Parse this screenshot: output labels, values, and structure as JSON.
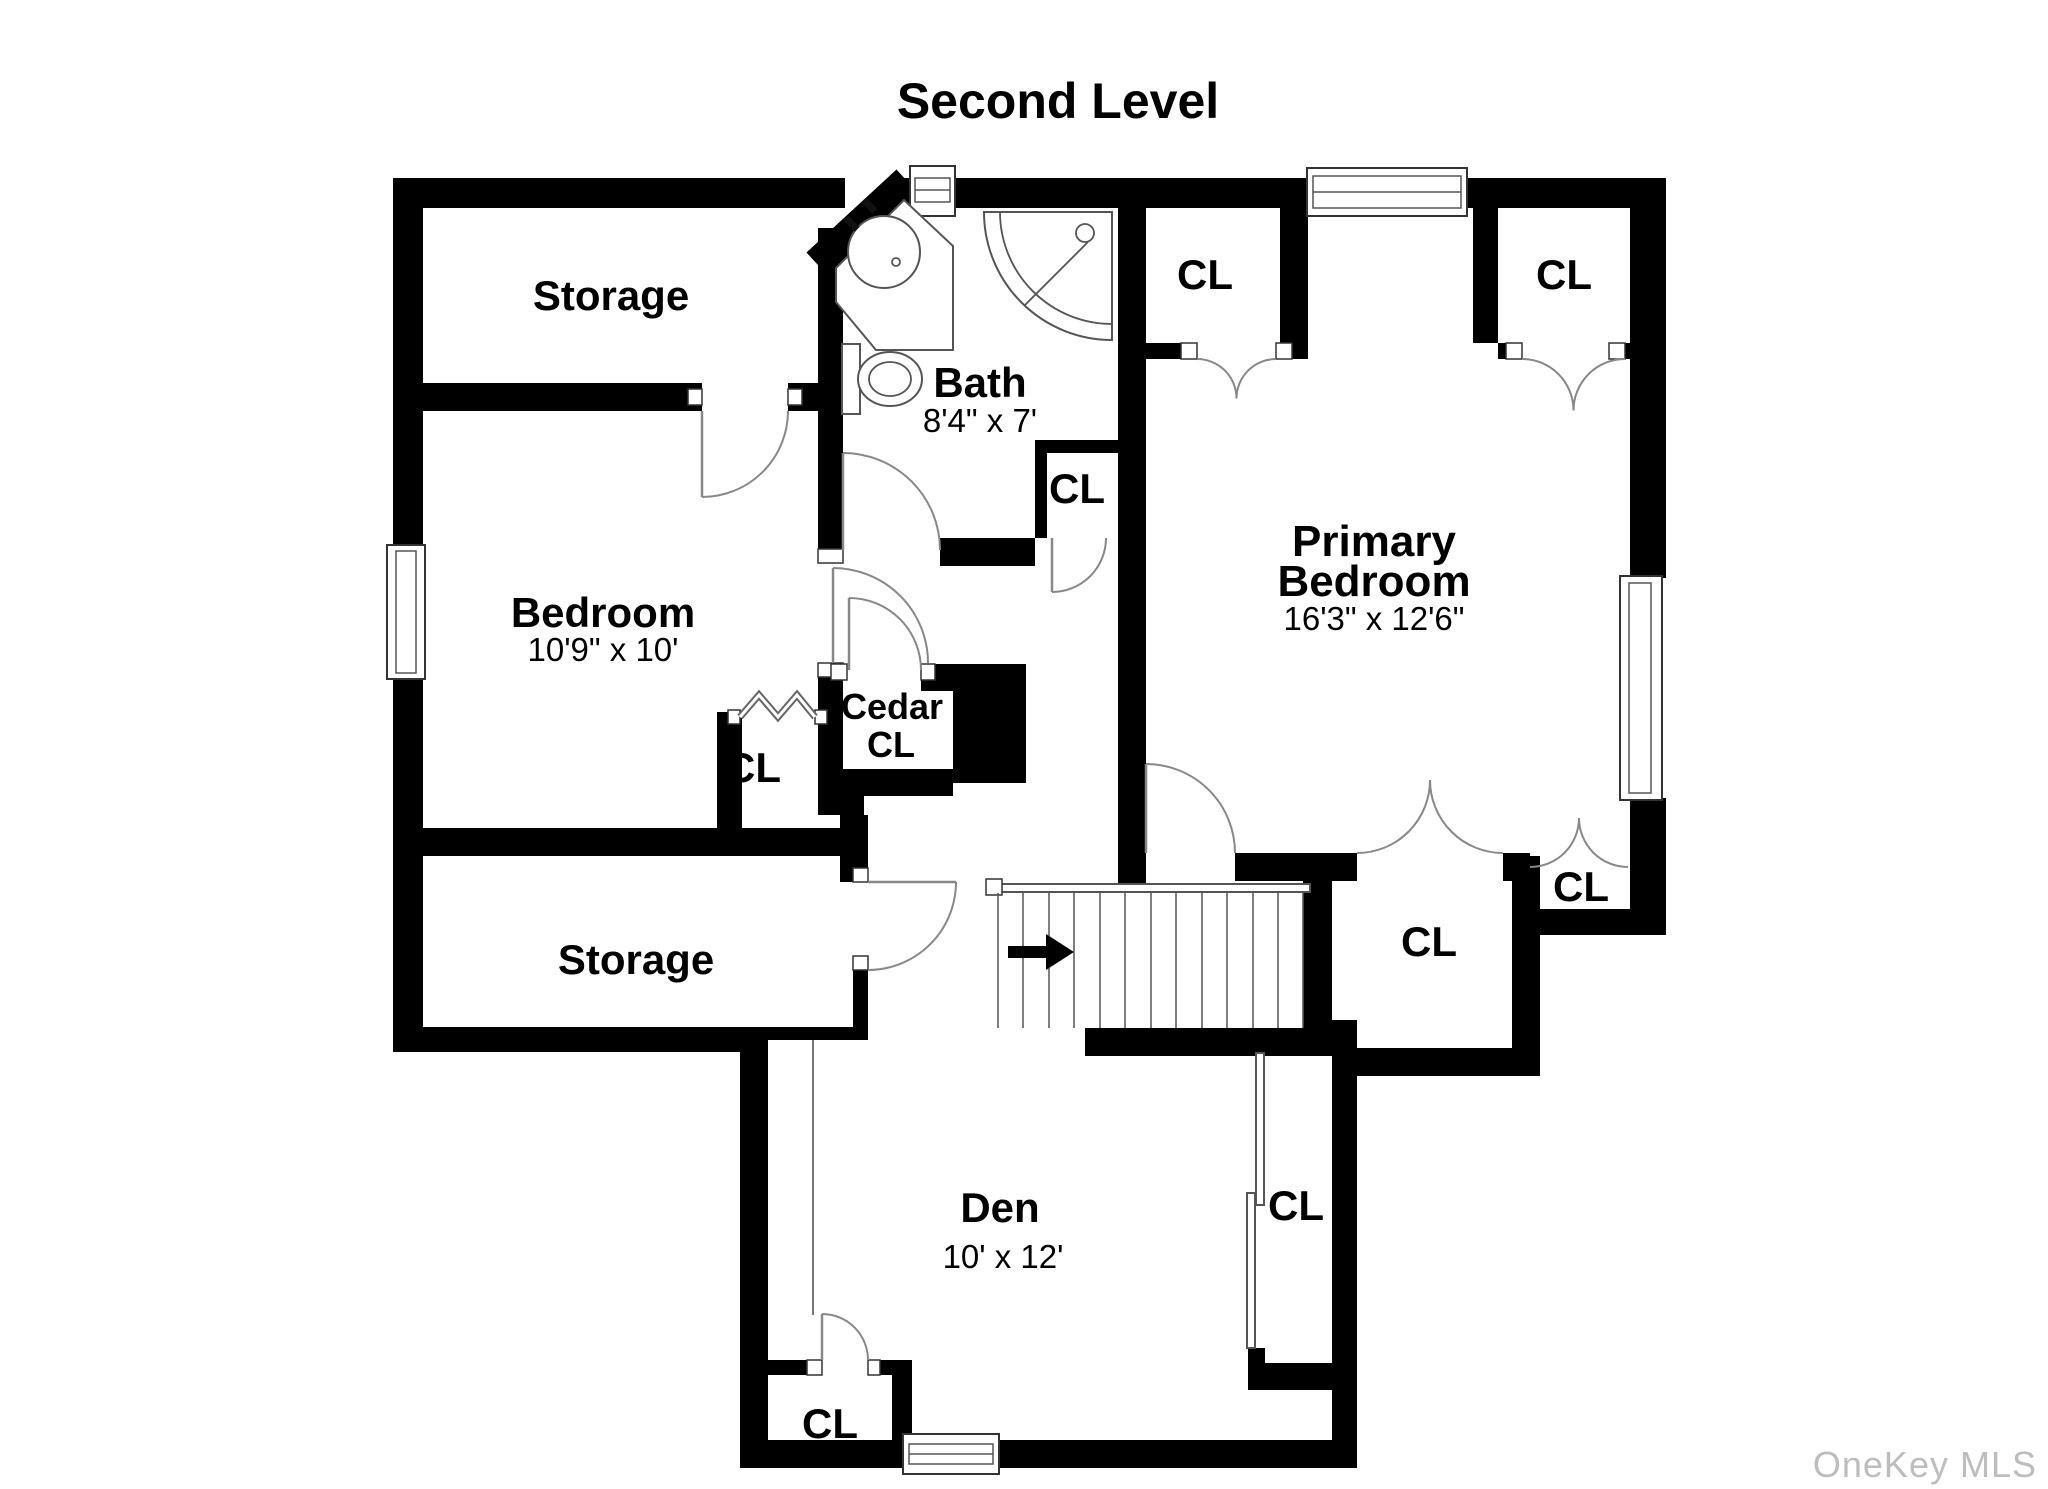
{
  "title": "Second Level",
  "watermark": "OneKey MLS",
  "rooms": {
    "storage_top": {
      "label": "Storage"
    },
    "storage_bottom": {
      "label": "Storage"
    },
    "bedroom": {
      "label": "Bedroom",
      "dims": "10'9\" x 10'"
    },
    "bath": {
      "label": "Bath",
      "dims": "8'4\" x 7'"
    },
    "primary_bedroom": {
      "label_line1": "Primary",
      "label_line2": "Bedroom",
      "dims": "16'3\" x 12'6\""
    },
    "cedar_closet": {
      "label_line1": "Cedar",
      "label_line2": "CL"
    },
    "den": {
      "label": "Den",
      "dims": "10' x 12'"
    }
  },
  "closet_labels": [
    {
      "id": "bath-closet",
      "label": "CL"
    },
    {
      "id": "bedroom-closet",
      "label": "CL"
    },
    {
      "id": "primary-closet-left",
      "label": "CL"
    },
    {
      "id": "primary-closet-right",
      "label": "CL"
    },
    {
      "id": "hall-closet-large",
      "label": "CL"
    },
    {
      "id": "hall-closet-small",
      "label": "CL"
    },
    {
      "id": "den-closet-east",
      "label": "CL"
    },
    {
      "id": "den-closet-southwest",
      "label": "CL"
    }
  ],
  "stairs": {
    "direction": "up-right"
  },
  "colors": {
    "wall": "#000000",
    "door_line": "#888888",
    "fixture_line": "#555555",
    "watermark": "#bdbdbd",
    "background": "#ffffff"
  }
}
